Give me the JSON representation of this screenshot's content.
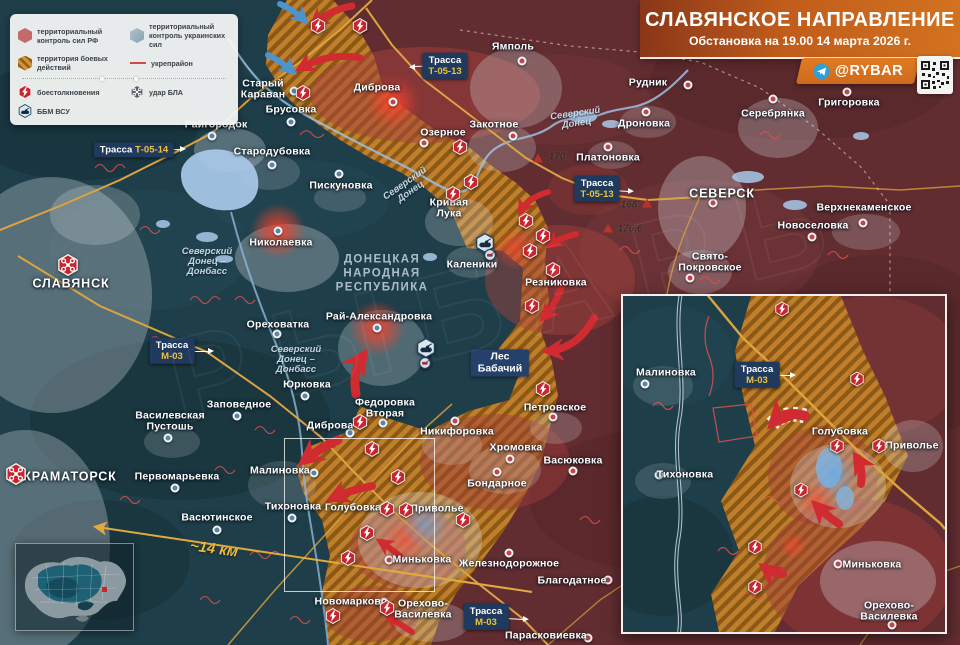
{
  "header": {
    "title": "СЛАВЯНСКОЕ НАПРАВЛЕНИЕ",
    "subtitle": "Обстановка на 19.00 14 марта 2026 г.",
    "channel": "@RYBAR"
  },
  "legend": {
    "items": [
      {
        "label": "территориальный контроль сил РФ"
      },
      {
        "label": "территориальный контроль украинских сил"
      },
      {
        "label": "территория боевых действий"
      },
      {
        "label": "укрепрайон"
      },
      {
        "label": "боестолкновения"
      },
      {
        "label": "удар БЛА"
      },
      {
        "label": "ББМ ВСУ"
      }
    ]
  },
  "colors": {
    "ru_zone": "#622d31",
    "ua_zone": "#1e3e49",
    "battle_zone": "#c8862b",
    "road": "#dca440",
    "fortline": "#e0524d",
    "title_accent": "#cf6a1d",
    "label_box": "#1f3a5c",
    "road_code": "#ecc23e",
    "clash_icon": "#c9252c"
  },
  "map": {
    "watermark": "РЫБАРЬ",
    "distance": {
      "text": "~14 км",
      "x": 214,
      "y": 549,
      "rot": 8
    },
    "places": [
      {
        "name": "СЛАВЯНСК",
        "lx": 71,
        "ly": 284,
        "caps": true
      },
      {
        "name": "КРАМАТОРСК",
        "lx": 70,
        "ly": 477,
        "caps": true
      },
      {
        "name": "СЕВЕРСК",
        "lx": 722,
        "ly": 194,
        "caps": true,
        "dot": [
          713,
          203
        ],
        "side": "ru"
      },
      {
        "name": "Райгородок",
        "lx": 216,
        "ly": 125,
        "dot": [
          212,
          136
        ],
        "side": "ua"
      },
      {
        "name": "Старый\nКараван",
        "lx": 263,
        "ly": 90,
        "dot": [
          294,
          91
        ],
        "side": "ua"
      },
      {
        "name": "Брусовка",
        "lx": 291,
        "ly": 110,
        "dot": [
          291,
          122
        ],
        "side": "ua"
      },
      {
        "name": "Стародубовка",
        "lx": 272,
        "ly": 152,
        "dot": [
          272,
          165
        ],
        "side": "ua"
      },
      {
        "name": "Пискуновка",
        "lx": 341,
        "ly": 186,
        "dot": [
          339,
          174
        ],
        "side": "ua"
      },
      {
        "name": "Диброва",
        "lx": 377,
        "ly": 88,
        "dot": [
          393,
          102
        ],
        "side": "ru",
        "glow": true
      },
      {
        "name": "Ямполь",
        "lx": 513,
        "ly": 47,
        "dot": [
          522,
          61
        ],
        "side": "ru"
      },
      {
        "name": "Озерное",
        "lx": 443,
        "ly": 133,
        "dot": [
          424,
          143
        ],
        "side": "ru"
      },
      {
        "name": "Закотное",
        "lx": 494,
        "ly": 125,
        "dot": [
          513,
          136
        ],
        "side": "ru"
      },
      {
        "name": "Рудник",
        "lx": 648,
        "ly": 83,
        "dot": [
          688,
          85
        ],
        "side": "ru"
      },
      {
        "name": "Дроновка",
        "lx": 644,
        "ly": 124,
        "dot": [
          646,
          112
        ],
        "side": "ru"
      },
      {
        "name": "Платоновка",
        "lx": 608,
        "ly": 158,
        "dot": [
          608,
          147
        ],
        "side": "ru"
      },
      {
        "name": "Серебрянка",
        "lx": 773,
        "ly": 114,
        "dot": [
          773,
          99
        ],
        "side": "ru"
      },
      {
        "name": "Григоровка",
        "lx": 849,
        "ly": 103,
        "dot": [
          847,
          92
        ],
        "side": "ru"
      },
      {
        "name": "Новоселовка",
        "lx": 813,
        "ly": 226,
        "dot": [
          812,
          237
        ],
        "side": "ru"
      },
      {
        "name": "Верхнекаменское",
        "lx": 864,
        "ly": 208,
        "dot": [
          863,
          223
        ],
        "side": "ru"
      },
      {
        "name": "Свято-\nПокровское",
        "lx": 710,
        "ly": 263,
        "dot": [
          690,
          278
        ],
        "side": "ru"
      },
      {
        "name": "Кривая\nЛука",
        "lx": 449,
        "ly": 209
      },
      {
        "name": "Николаевка",
        "lx": 281,
        "ly": 243,
        "dot": [
          278,
          231
        ],
        "side": "ua",
        "glow": true
      },
      {
        "name": "Каленики",
        "lx": 472,
        "ly": 265
      },
      {
        "name": "Резниковка",
        "lx": 556,
        "ly": 283
      },
      {
        "name": "Ореховатка",
        "lx": 278,
        "ly": 325,
        "dot": [
          277,
          334
        ],
        "side": "ua"
      },
      {
        "name": "Рай-Александровка",
        "lx": 379,
        "ly": 317,
        "dot": [
          377,
          328
        ],
        "side": "ua",
        "glow": true
      },
      {
        "name": "Юрковка",
        "lx": 307,
        "ly": 385,
        "dot": [
          305,
          396
        ],
        "side": "ua"
      },
      {
        "name": "Заповедное",
        "lx": 239,
        "ly": 405,
        "dot": [
          237,
          416
        ],
        "side": "ua"
      },
      {
        "name": "Василевская\nПустошь",
        "lx": 170,
        "ly": 422,
        "dot": [
          168,
          438
        ],
        "side": "ua"
      },
      {
        "name": "Федоровка\nВторая",
        "lx": 385,
        "ly": 409,
        "dot": [
          383,
          423
        ],
        "side": "ua"
      },
      {
        "name": "Диброва",
        "lx": 330,
        "ly": 426,
        "dot": [
          350,
          433
        ],
        "side": "ua"
      },
      {
        "name": "Никифоровка",
        "lx": 457,
        "ly": 432,
        "dot": [
          455,
          421
        ],
        "side": "ru"
      },
      {
        "name": "Петровское",
        "lx": 555,
        "ly": 408,
        "dot": [
          553,
          417
        ],
        "side": "ru"
      },
      {
        "name": "Хромовка",
        "lx": 516,
        "ly": 448,
        "dot": [
          510,
          459
        ],
        "side": "ru"
      },
      {
        "name": "Васюковка",
        "lx": 573,
        "ly": 461,
        "dot": [
          573,
          471
        ],
        "side": "ru"
      },
      {
        "name": "Бондарное",
        "lx": 497,
        "ly": 484,
        "dot": [
          497,
          472
        ],
        "side": "ru"
      },
      {
        "name": "Первомарьевка",
        "lx": 177,
        "ly": 477,
        "dot": [
          175,
          488
        ],
        "side": "ua"
      },
      {
        "name": "Васютинское",
        "lx": 217,
        "ly": 518,
        "dot": [
          217,
          530
        ],
        "side": "ua"
      },
      {
        "name": "Малиновка",
        "lx": 280,
        "ly": 471,
        "dot": [
          314,
          473
        ],
        "side": "ua"
      },
      {
        "name": "Тихоновка",
        "lx": 293,
        "ly": 507,
        "dot": [
          292,
          518
        ],
        "side": "ua"
      },
      {
        "name": "Голубовка",
        "lx": 353,
        "ly": 508
      },
      {
        "name": "Приволье",
        "lx": 437,
        "ly": 509
      },
      {
        "name": "Миньковка",
        "lx": 422,
        "ly": 560,
        "dot": [
          389,
          560
        ],
        "side": "ru"
      },
      {
        "name": "Железнодорожное",
        "lx": 509,
        "ly": 564,
        "dot": [
          509,
          553
        ],
        "side": "ru"
      },
      {
        "name": "Благодатное",
        "lx": 572,
        "ly": 581,
        "dot": [
          608,
          580
        ],
        "side": "ru"
      },
      {
        "name": "Новомарково",
        "lx": 351,
        "ly": 602,
        "dot": [
          384,
          602
        ],
        "side": "ru"
      },
      {
        "name": "Орехово-\nВасилевка",
        "lx": 423,
        "ly": 610
      },
      {
        "name": "Парасковиевка",
        "lx": 546,
        "ly": 636,
        "dot": [
          588,
          638
        ],
        "side": "ru"
      }
    ],
    "area_labels": [
      {
        "text": "ДОНЕЦКАЯ\nНАРОДНАЯ\nРЕСПУБЛИКА",
        "x": 382,
        "y": 274,
        "cls": "region"
      },
      {
        "text": "Северский\nДонец",
        "x": 408,
        "y": 188,
        "cls": "river",
        "rot": -35
      },
      {
        "text": "Северский\nДонец",
        "x": 576,
        "y": 119,
        "cls": "river",
        "rot": -8
      },
      {
        "text": "Северский\nДонец –\nДонбасс",
        "x": 207,
        "y": 262,
        "cls": "river"
      },
      {
        "text": "Северский\nДонец –\nДонбасс",
        "x": 296,
        "y": 360,
        "cls": "river"
      },
      {
        "text": "Лес\nБабачий",
        "x": 500,
        "y": 363,
        "cls": "forest"
      }
    ],
    "road_labels": [
      {
        "prefix": "Трасса",
        "code": "Т-05-14",
        "x": 134,
        "y": 150,
        "tip": [
          181,
          149
        ],
        "layout": "row"
      },
      {
        "prefix": "Трасса",
        "code": "Т-05-13",
        "x": 445,
        "y": 66,
        "tip": [
          414,
          67
        ],
        "layout": "col"
      },
      {
        "prefix": "Трасса",
        "code": "Т-05-13",
        "x": 597,
        "y": 189,
        "tip": [
          629,
          191
        ],
        "layout": "col"
      },
      {
        "prefix": "Трасса",
        "code": "М-03",
        "x": 172,
        "y": 351,
        "tip": [
          209,
          351
        ],
        "layout": "col"
      },
      {
        "prefix": "Трасса",
        "code": "М-03",
        "x": 486,
        "y": 617,
        "tip": [
          524,
          619
        ],
        "layout": "col"
      }
    ],
    "heights": [
      {
        "text": "170",
        "x": 557,
        "y": 157,
        "tri": [
          538,
          158
        ]
      },
      {
        "text": "168",
        "x": 629,
        "y": 205,
        "tri": [
          647,
          203
        ]
      },
      {
        "text": "176,6",
        "x": 630,
        "y": 229,
        "tri": [
          608,
          228
        ]
      }
    ],
    "clash_icons": [
      [
        303,
        93
      ],
      [
        318,
        26
      ],
      [
        360,
        26
      ],
      [
        460,
        147
      ],
      [
        471,
        182
      ],
      [
        453,
        194
      ],
      [
        526,
        221
      ],
      [
        543,
        236
      ],
      [
        530,
        251
      ],
      [
        553,
        270
      ],
      [
        532,
        306
      ],
      [
        543,
        389
      ],
      [
        360,
        422
      ],
      [
        372,
        449
      ],
      [
        398,
        477
      ],
      [
        387,
        509
      ],
      [
        406,
        510
      ],
      [
        463,
        520
      ],
      [
        367,
        533
      ],
      [
        348,
        558
      ],
      [
        333,
        616
      ],
      [
        387,
        608
      ]
    ],
    "uav_icons": [
      [
        68,
        265
      ],
      [
        16,
        474
      ]
    ],
    "bbm_icons": [
      [
        485,
        243
      ],
      [
        426,
        348
      ]
    ],
    "bbm_small_icons": [
      [
        490,
        255
      ],
      [
        425,
        363
      ]
    ]
  },
  "inset": {
    "places": [
      {
        "name": "Малиновка",
        "lx": 43,
        "ly": 77,
        "dot": [
          22,
          88
        ],
        "side": "ua"
      },
      {
        "name": "Тихоновка",
        "lx": 62,
        "ly": 179,
        "dot": [
          36,
          179
        ],
        "side": "ua"
      },
      {
        "name": "Голубовка",
        "lx": 217,
        "ly": 136
      },
      {
        "name": "Приволье",
        "lx": 289,
        "ly": 150
      },
      {
        "name": "Миньковка",
        "lx": 249,
        "ly": 269,
        "dot": [
          215,
          268
        ],
        "side": "ru"
      },
      {
        "name": "Орехово-Василевка",
        "lx": 266,
        "ly": 316,
        "dot": [
          269,
          329
        ],
        "side": "ru"
      }
    ],
    "road_labels": [
      {
        "prefix": "Трасса",
        "code": "М-03",
        "x": 134,
        "y": 79,
        "tip": [
          168,
          79
        ],
        "layout": "col"
      }
    ],
    "clash_icons": [
      [
        159,
        13
      ],
      [
        234,
        83
      ],
      [
        214,
        150
      ],
      [
        256,
        150
      ],
      [
        178,
        194
      ],
      [
        132,
        251
      ],
      [
        132,
        291
      ]
    ]
  }
}
